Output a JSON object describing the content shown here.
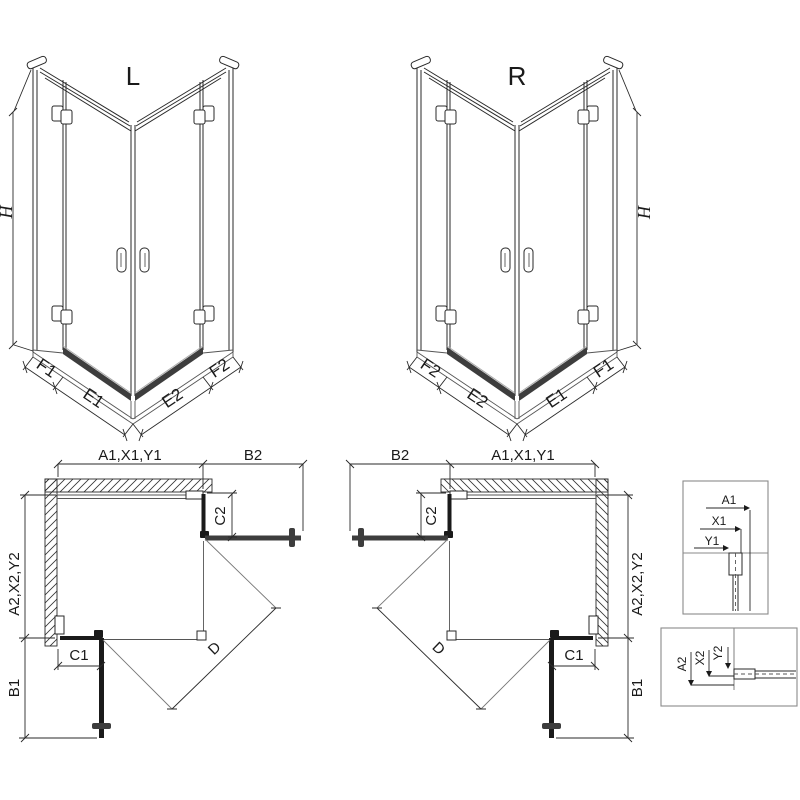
{
  "perspective_left": {
    "title": "L",
    "height": "H",
    "f1": "F1",
    "e1": "E1",
    "e2": "E2",
    "f2": "F2"
  },
  "perspective_right": {
    "title": "R",
    "height": "H",
    "f1": "F1",
    "e1": "E1",
    "e2": "E2",
    "f2": "F2"
  },
  "plan_left": {
    "width": "A1,X1,Y1",
    "door": "B2",
    "return_panel": "C2",
    "depth": "A2,X2,Y2",
    "side_door": "B1",
    "side_panel": "C1",
    "diagonal": "D"
  },
  "plan_right": {
    "width": "A1,X1,Y1",
    "door": "B2",
    "return_panel": "C2",
    "depth": "A2,X2,Y2",
    "side_door": "B1",
    "side_panel": "C1",
    "diagonal": "D"
  },
  "detail_top_wall": {
    "a": "A1",
    "x": "X1",
    "y": "Y1"
  },
  "detail_side_wall": {
    "a": "A2",
    "x": "X2",
    "y": "Y2"
  }
}
